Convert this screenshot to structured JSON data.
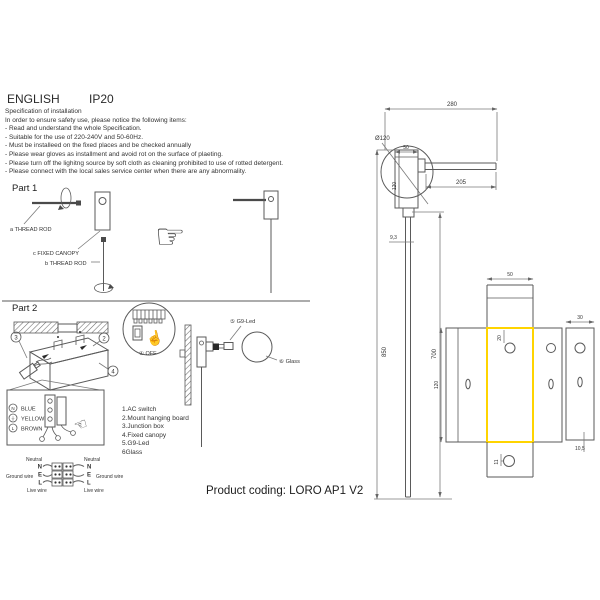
{
  "header": {
    "language": "ENGLISH",
    "ip_rating": "IP20"
  },
  "spec": {
    "title": "Specification of installation",
    "intro": "In order to ensure safety use, please notice the following items:",
    "items": [
      "- Read and understand the whole Specification.",
      "- Suitable for the use of 220-240V and 50-60Hz.",
      "- Must be installeed on the fixed places and be checked annually",
      "- Please wear gloves as installment and avoid rot on the surface of plaeting.",
      "- Please turn off the lighitng source by soft cloth as cleaning prohibited to use of rotted detergent.",
      "- Please connect with the local sales service center when there are any abnormality."
    ]
  },
  "part1": {
    "title": "Part 1",
    "label_a": "a THREAD ROD",
    "label_c": "c FIXED CANOPY",
    "label_b": "b THREAD ROD"
  },
  "part2": {
    "title": "Part 2",
    "callout_1_off": "① OFF",
    "callout_2": "2",
    "callout_3": "3",
    "callout_4": "4",
    "callout_5_label": "⑤ G9-Led",
    "callout_6_label": "⑥ Glass",
    "wire_colors": [
      {
        "terminal": "N",
        "color": "BLUE"
      },
      {
        "terminal": "⏚",
        "color": "YELLOW"
      },
      {
        "terminal": "L",
        "color": "BROWN"
      }
    ],
    "parts_list": [
      "1.AC switch",
      "2.Mount hanging board",
      "3.Junction box",
      "4.Fixed canopy",
      "5.G9-Led",
      "6Glass"
    ],
    "wiring": {
      "neutral": "Neutral",
      "ground": "Ground wire",
      "live": "Live wire",
      "n": "N",
      "e": "E",
      "l": "L"
    }
  },
  "product": {
    "coding": "Product coding: LORO AP1 V2"
  },
  "drawing": {
    "highlight_color": "#ffd400",
    "dims": {
      "top_width": "280",
      "diameter": "Ø120",
      "canopy_width": "50",
      "canopy_height": "120",
      "arm_length": "205",
      "rod_diameter": "9,3",
      "overall_height": "850",
      "rod_length": "700",
      "tab_width": "50",
      "hole_offset": "20",
      "plate_height": "120",
      "bottom_hole_offset": "11",
      "side_plate_width": "30",
      "side_plate_offset": "10,5"
    }
  }
}
